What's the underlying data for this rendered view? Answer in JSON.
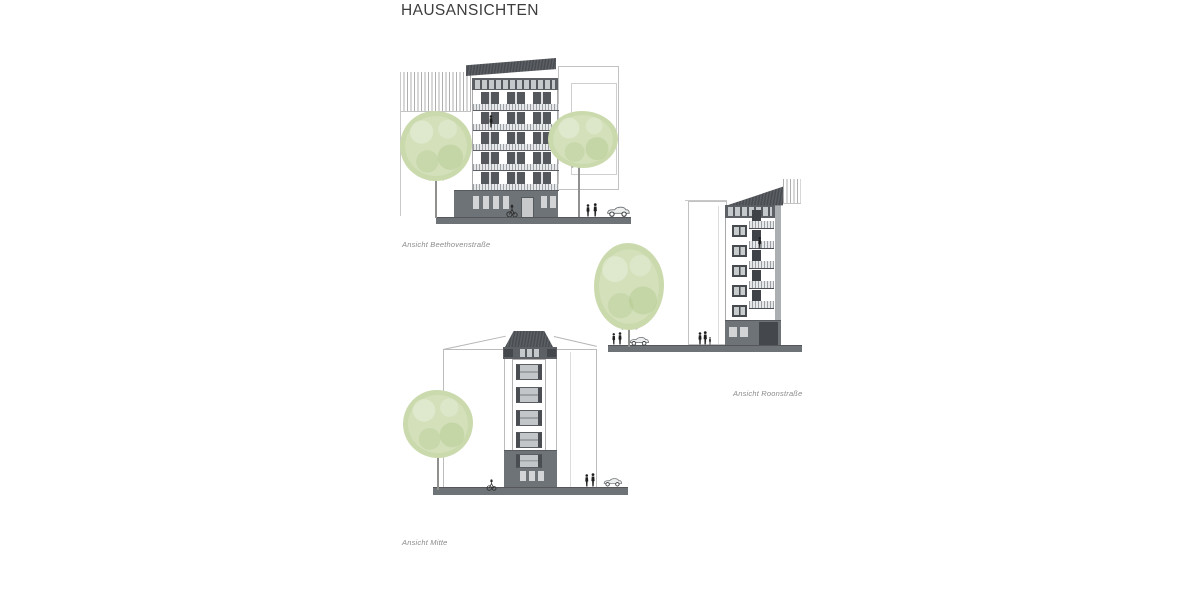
{
  "page": {
    "title": "HAUSANSICHTEN",
    "background": "#ffffff"
  },
  "elevations": [
    {
      "id": "beethovenstrasse",
      "label": "Ansicht Beethovenstraße"
    },
    {
      "id": "roonstrasse",
      "label": "Ansicht Roonstraße"
    },
    {
      "id": "mitte",
      "label": "Ansicht Mitte"
    }
  ],
  "icons": {
    "tree": "tree-icon",
    "person": "person-icon",
    "car": "car-icon",
    "bicycle": "bicycle-icon"
  },
  "colors": {
    "roof_dark": "#55585c",
    "band_dark": "#5d6165",
    "plinth_gray": "#6e7377",
    "window_frame": "#4a4e52",
    "glazing_light": "#c6c9cb",
    "tree_green": "#cfdcb2",
    "outline_gray": "#bdbdbd",
    "ground_gray": "#6e7377",
    "label_gray": "#8a8a8a",
    "title_color": "#3d3d3d"
  }
}
